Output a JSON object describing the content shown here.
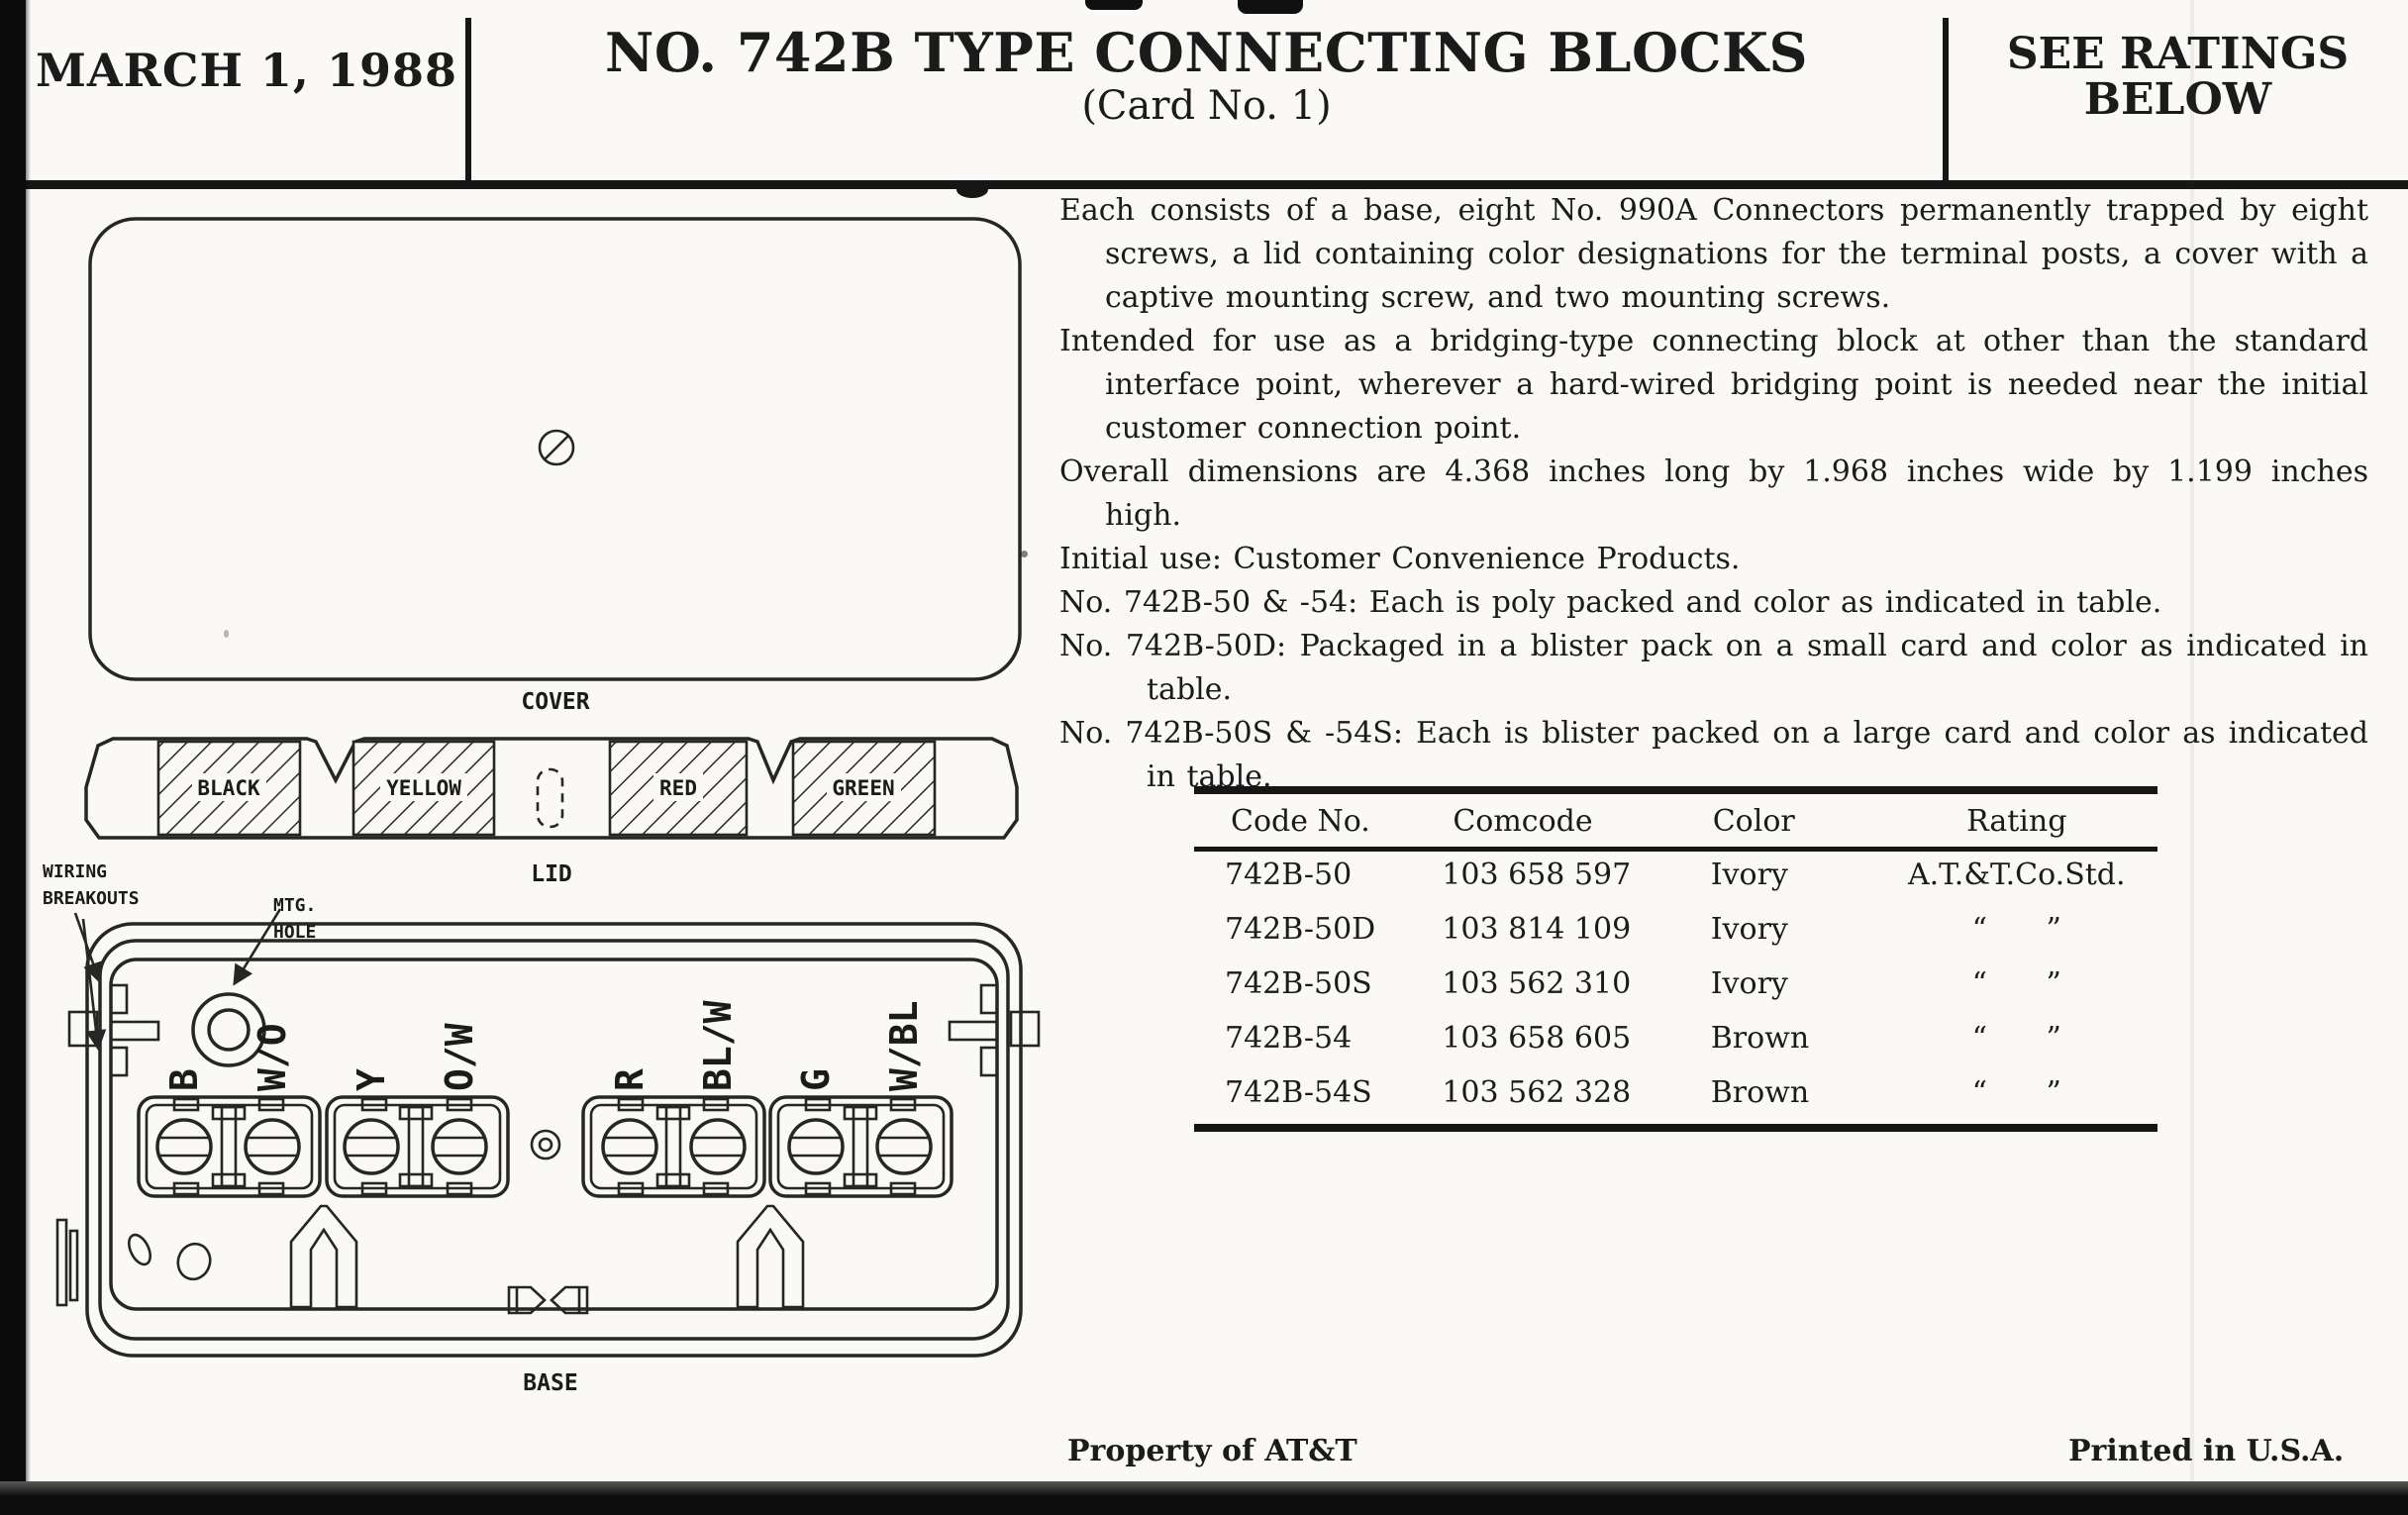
{
  "header": {
    "date": "MARCH 1, 1988",
    "title": "NO. 742B TYPE CONNECTING BLOCKS",
    "subtitle": "(Card No. 1)",
    "ratings_note": "SEE RATINGS BELOW"
  },
  "description": {
    "paragraphs": [
      "Each consists of a base, eight No. 990A Connectors permanently trapped by eight screws, a lid containing color designations for the terminal posts, a cover with a captive mounting screw, and two mounting screws.",
      "Intended for use as a bridging-type connecting block at other than the standard interface point, wherever a hard-wired bridging point is needed near the initial customer connection point.",
      "Overall dimensions are 4.368 inches long by 1.968 inches wide by 1.199 inches high.",
      "Initial use: Customer Convenience Products.",
      "No. 742B-50 & -54: Each is poly packed and color as indicated in table.",
      "No. 742B-50D: Packaged in a blister pack on a small card and color as indicated in table.",
      "No. 742B-50S & -54S: Each is blister packed on a large card and color as indicated in table."
    ]
  },
  "ratings_table": {
    "headers": [
      "Code No.",
      "Comcode",
      "Color",
      "Rating"
    ],
    "rows": [
      [
        "742B-50",
        "103 658 597",
        "Ivory",
        "A.T.&T.Co.Std."
      ],
      [
        "742B-50D",
        "103 814 109",
        "Ivory",
        "“ ”"
      ],
      [
        "742B-50S",
        "103 562 310",
        "Ivory",
        "“ ”"
      ],
      [
        "742B-54",
        "103 658 605",
        "Brown",
        "“ ”"
      ],
      [
        "742B-54S",
        "103 562 328",
        "Brown",
        "“ ”"
      ]
    ]
  },
  "diagram": {
    "cover_label": "COVER",
    "lid_label": "LID",
    "base_label": "BASE",
    "lid_colors": [
      "BLACK",
      "YELLOW",
      "RED",
      "GREEN"
    ],
    "callouts": {
      "wiring_line1": "WIRING",
      "wiring_line2": "BREAKOUTS",
      "mtg_line1": "MTG.",
      "mtg_line2": "HOLE"
    },
    "terminals": [
      "B",
      "W/O",
      "Y",
      "O/W",
      "R",
      "BL/W",
      "G",
      "W/BL"
    ]
  },
  "footer": {
    "left": "Property of AT&T",
    "right": "Printed in U.S.A."
  },
  "colors": {
    "ink": "#1b1b1b",
    "paper": "#faf9f5",
    "scan_edge": "#0b0b0b"
  }
}
